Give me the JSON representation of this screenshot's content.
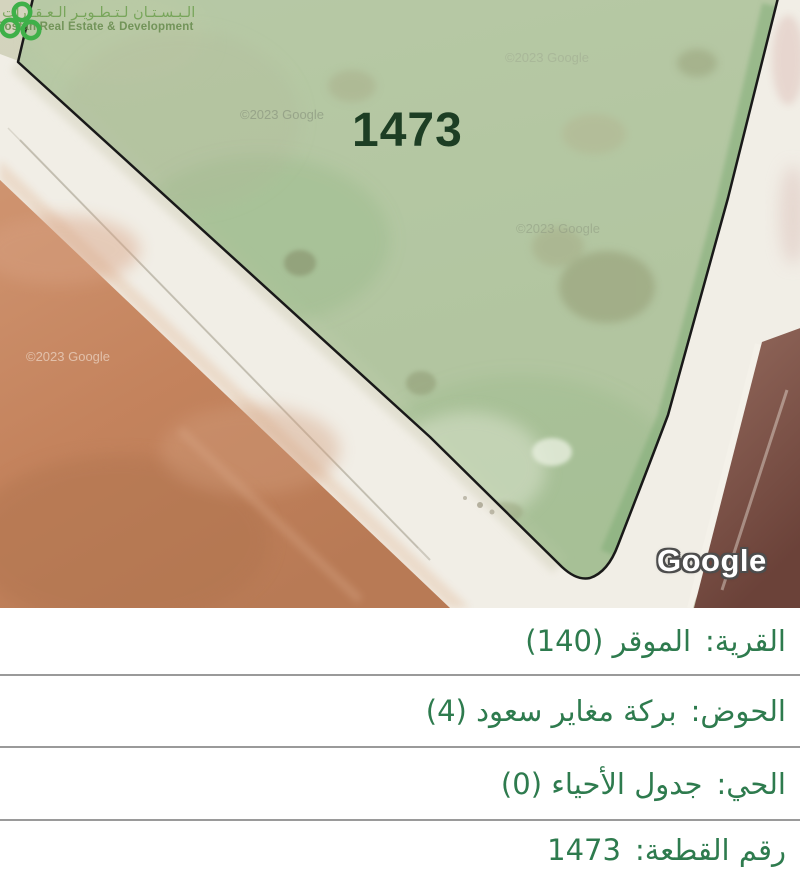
{
  "brand": {
    "name_ar": "الـبـسـتـان لـتـطـويـر الـعـقـارات",
    "name_en": "Bostan Real Estate & Development"
  },
  "map": {
    "parcel_label": "1473",
    "copyright_watermark": "©2023 Google",
    "google_logo": "Google",
    "colors": {
      "parcel_tint": "#8fbb84",
      "parcel_outline": "#191919",
      "brand_green": "#3fb049",
      "road_white": "#f1eee6",
      "soil_brown": "#c68a64",
      "dark_soil": "#7c5449"
    }
  },
  "details": {
    "text_color": "#2e7b4e",
    "rows": [
      {
        "label": "القرية:",
        "value": "الموقر (140)"
      },
      {
        "label": "الحوض:",
        "value": "بركة مغاير سعود (4)"
      },
      {
        "label": "الحي:",
        "value": "جدول الأحياء (0)"
      },
      {
        "label": "رقم القطعة:",
        "value": "1473"
      }
    ]
  }
}
